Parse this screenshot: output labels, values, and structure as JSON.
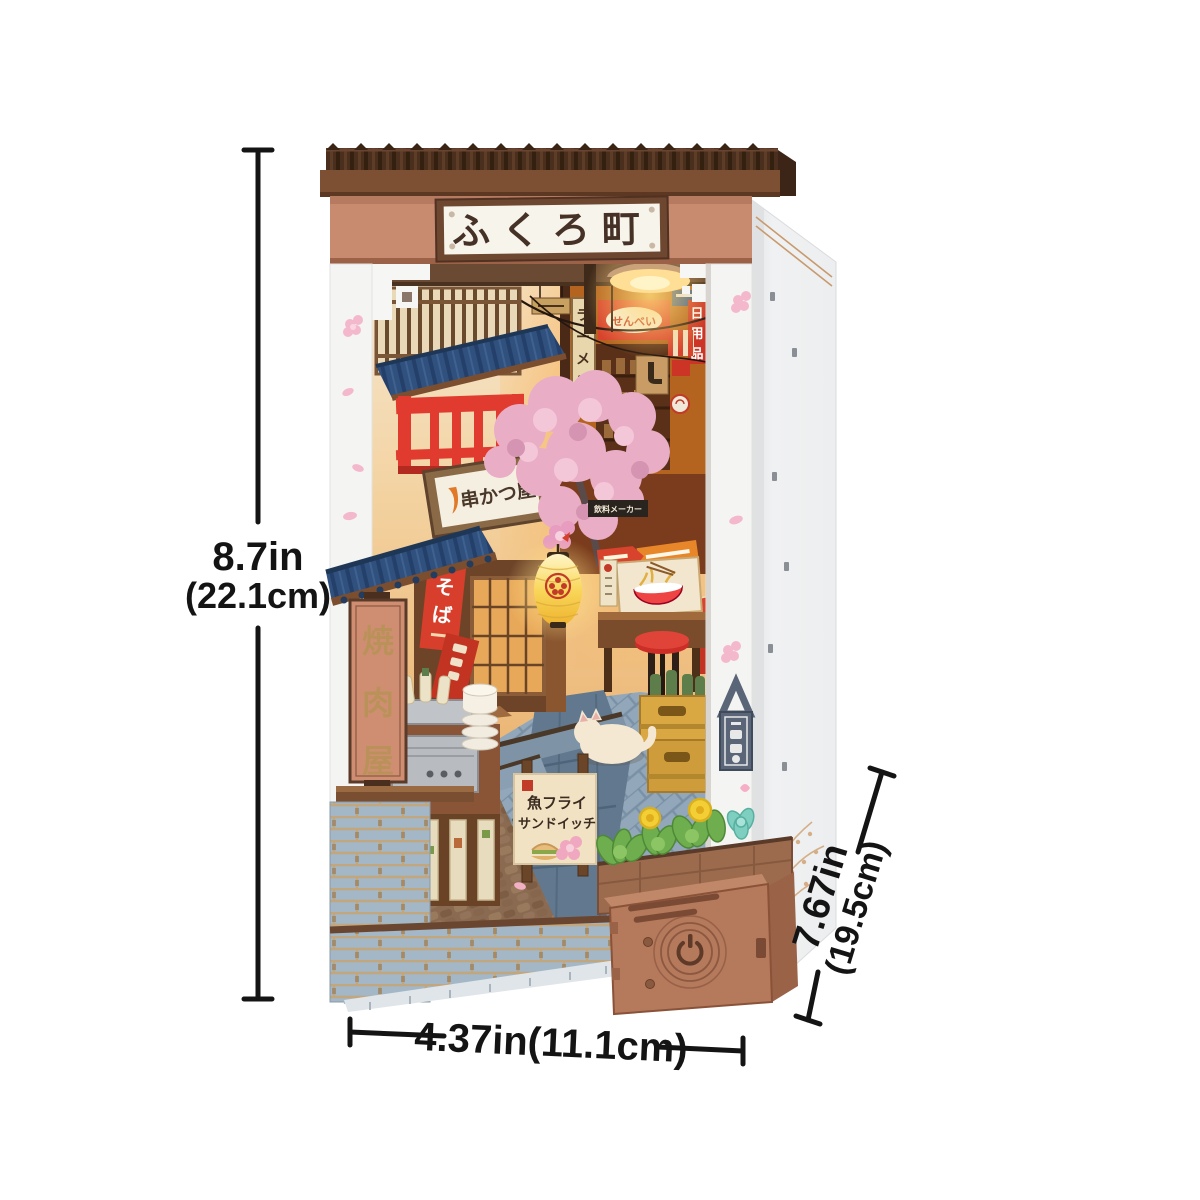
{
  "product": {
    "kind": "book-nook miniature kit photo",
    "marquee_sign": "ふくろ町"
  },
  "signs": {
    "marquee": "ふくろ町",
    "senbei": "せんべい",
    "daily_goods": "日用品",
    "ramen": "ラーメン",
    "soba": "そば",
    "yakiniku_ya": "焼肉屋",
    "beverage_maker": "飲料メーカー",
    "momiji_manju": "もみじ饅頭",
    "fish_fry": "魚フライ",
    "sandwich": "サンドイッチ",
    "kushikatsu_ya": "串かつ屋"
  },
  "annotations": {
    "height_in": "8.7in",
    "height_cm": "(22.1cm)",
    "width": "4.37in(11.1cm)",
    "depth_in": "7.67in",
    "depth_cm": "(19.5cm)"
  },
  "colors": {
    "background": "#ffffff",
    "roof_dark": "#4a2f1f",
    "fascia": "#7d4f33",
    "facade_salmon": "#c98b6f",
    "sign_plaque": "#f7f4ec",
    "accent_red": "#d8432e",
    "blue_roof": "#30507e",
    "lantern_yellow": "#f2bd3a",
    "brick_blue": "#a3b7c6",
    "kit_wood": "#b5795c",
    "annotation_ink": "#141414"
  }
}
